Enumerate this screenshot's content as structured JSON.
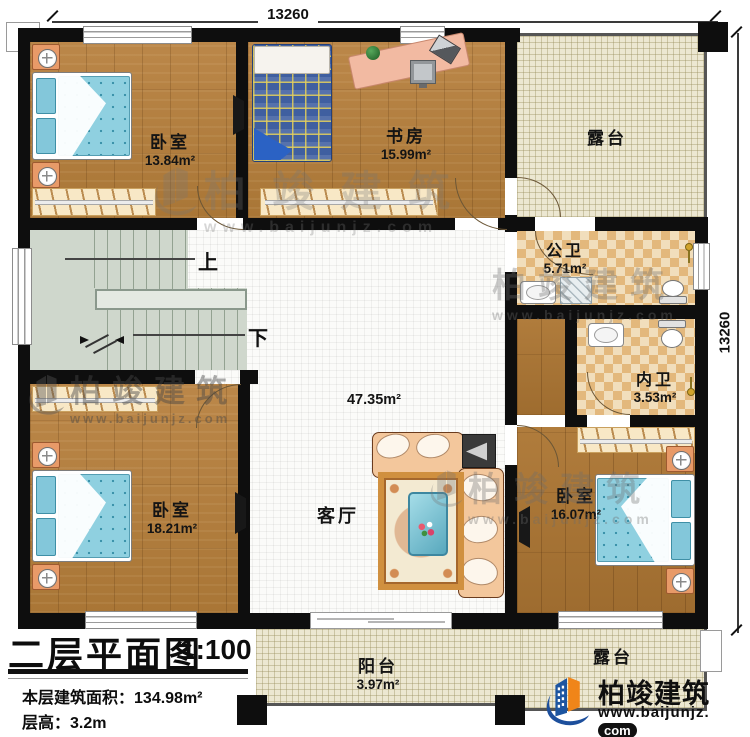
{
  "meta": {
    "plan_title": "二层平面图",
    "scale": "1:100",
    "area_label": "本层建筑面积：",
    "area_value": "134.98m²",
    "floor_height_label": "层高：",
    "floor_height_value": "3.2m"
  },
  "dimensions": {
    "top": "13260",
    "right": "13260"
  },
  "rooms": {
    "bedroom_tl": {
      "name": "卧室",
      "area": "13.84m²"
    },
    "study": {
      "name": "书房",
      "area": "15.99m²"
    },
    "terrace_top": {
      "name": "露台"
    },
    "public_bath": {
      "name": "公卫",
      "area": "5.71m²"
    },
    "ensuite_bath": {
      "name": "内卫",
      "area": "3.53m²"
    },
    "living": {
      "name": "客厅",
      "area": "47.35m²"
    },
    "bedroom_bl": {
      "name": "卧室",
      "area": "18.21m²"
    },
    "bedroom_r": {
      "name": "卧室",
      "area": "16.07m²"
    },
    "balcony": {
      "name": "阳台",
      "area": "3.97m²"
    },
    "terrace_bottom": {
      "name": "露台"
    }
  },
  "stairs": {
    "up": "上",
    "down": "下"
  },
  "brand": {
    "name": "柏竣建筑",
    "url": "www.baijunjz.com",
    "url_prefix": "www.baijunjz.",
    "url_suffix": "com"
  },
  "watermark": {
    "name": "柏竣建筑",
    "url": "www.baijunjz.com"
  },
  "colors": {
    "wall": "#0e0e0e",
    "wood": "#b28042",
    "terrace_tile": "#ece7d1",
    "checker_light": "#f1debc",
    "checker_dark": "#e3b87c",
    "stair": "#cfd7cc",
    "bed_blue": "#8fd0e0",
    "sofa_peach": "#f3c79c",
    "brand_orange": "#f08519",
    "brand_blue": "#1d55a0"
  }
}
